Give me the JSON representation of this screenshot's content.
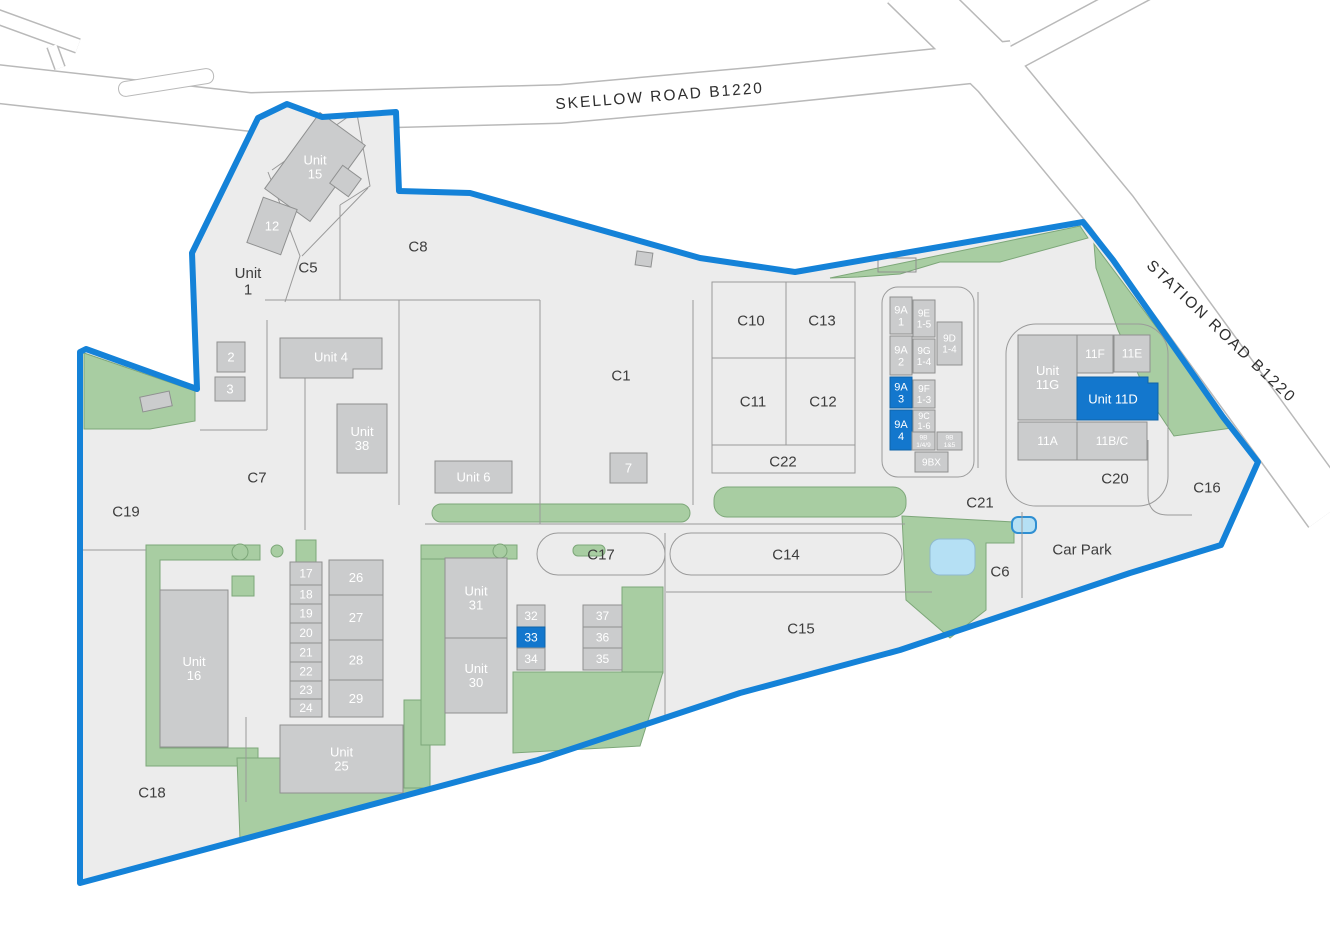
{
  "roads": {
    "skellow_label": "SKELLOW ROAD   B1220",
    "station_label": "STATION ROAD   B1220"
  },
  "colors": {
    "boundary": "#1482d8",
    "highlight": "#1377cd",
    "highlight_stroke": "#0f63a8",
    "building_fill": "#cbcccd",
    "building_stroke": "#8f9090",
    "parcel_fill": "#ececec",
    "line": "#9a9a9a",
    "green": "#a8cda2",
    "green_stroke": "#7da779",
    "pond": "#b5e0f4",
    "pond_stroke": "#8fb9cf",
    "small_pond_stroke": "#2f8fd2",
    "road_stroke": "#b9b9b9",
    "label": "#3d3d3d",
    "building_label": "#ffffff"
  },
  "parcels": [
    {
      "id": "unit-1",
      "lines": [
        "Unit",
        "1"
      ],
      "x": 248,
      "y": 281
    },
    {
      "id": "c5",
      "lines": [
        "C5"
      ],
      "x": 308,
      "y": 267
    },
    {
      "id": "c8",
      "lines": [
        "C8"
      ],
      "x": 418,
      "y": 246
    },
    {
      "id": "c7",
      "lines": [
        "C7"
      ],
      "x": 257,
      "y": 477
    },
    {
      "id": "c1",
      "lines": [
        "C1"
      ],
      "x": 621,
      "y": 375
    },
    {
      "id": "c10",
      "lines": [
        "C10"
      ],
      "x": 751,
      "y": 320
    },
    {
      "id": "c13",
      "lines": [
        "C13"
      ],
      "x": 822,
      "y": 320
    },
    {
      "id": "c11",
      "lines": [
        "C11"
      ],
      "x": 753,
      "y": 401
    },
    {
      "id": "c12",
      "lines": [
        "C12"
      ],
      "x": 823,
      "y": 401
    },
    {
      "id": "c22",
      "lines": [
        "C22"
      ],
      "x": 783,
      "y": 461
    },
    {
      "id": "c19",
      "lines": [
        "C19"
      ],
      "x": 126,
      "y": 511
    },
    {
      "id": "c18",
      "lines": [
        "C18"
      ],
      "x": 152,
      "y": 792
    },
    {
      "id": "c17",
      "lines": [
        "C17"
      ],
      "x": 601,
      "y": 554
    },
    {
      "id": "c14",
      "lines": [
        "C14"
      ],
      "x": 786,
      "y": 554
    },
    {
      "id": "c15",
      "lines": [
        "C15"
      ],
      "x": 801,
      "y": 628
    },
    {
      "id": "c21",
      "lines": [
        "C21"
      ],
      "x": 980,
      "y": 502
    },
    {
      "id": "c6",
      "lines": [
        "C6"
      ],
      "x": 1000,
      "y": 571
    },
    {
      "id": "car-park",
      "lines": [
        "Car Park"
      ],
      "x": 1082,
      "y": 549
    },
    {
      "id": "c20",
      "lines": [
        "C20"
      ],
      "x": 1115,
      "y": 478
    },
    {
      "id": "c16",
      "lines": [
        "C16"
      ],
      "x": 1207,
      "y": 487
    }
  ],
  "buildings": [
    {
      "id": "unit-15",
      "lines": [
        "Unit",
        "15"
      ],
      "x": 287,
      "y": 120,
      "w": 56,
      "h": 94,
      "rot": 36,
      "fs": 13
    },
    {
      "id": "unit-15-annex",
      "lines": [],
      "x": 334,
      "y": 170,
      "w": 23,
      "h": 22,
      "rot": 36
    },
    {
      "id": "unit-12",
      "lines": [
        "12"
      ],
      "x": 254,
      "y": 202,
      "w": 36,
      "h": 48,
      "rot": 20,
      "fs": 13
    },
    {
      "id": "unit-2",
      "lines": [
        "2"
      ],
      "x": 217,
      "y": 342,
      "w": 28,
      "h": 30,
      "fs": 13
    },
    {
      "id": "unit-3",
      "lines": [
        "3"
      ],
      "x": 215,
      "y": 377,
      "w": 30,
      "h": 24,
      "fs": 13
    },
    {
      "id": "unit-4",
      "lines": [
        "Unit 4"
      ],
      "pts": "280,338 382,338 382,369 353,369 353,378 280,378",
      "lx": 331,
      "ly": 357,
      "fs": 13
    },
    {
      "id": "unit-38",
      "lines": [
        "Unit",
        "38"
      ],
      "x": 337,
      "y": 404,
      "w": 50,
      "h": 69,
      "fs": 13
    },
    {
      "id": "unit-6",
      "lines": [
        "Unit 6"
      ],
      "x": 435,
      "y": 461,
      "w": 77,
      "h": 32,
      "fs": 13
    },
    {
      "id": "unit-7",
      "lines": [
        "7"
      ],
      "x": 610,
      "y": 453,
      "w": 37,
      "h": 30,
      "fs": 13
    },
    {
      "id": "kiosk-c1",
      "lines": [],
      "x": 636,
      "y": 252,
      "w": 16,
      "h": 14,
      "rot": 8
    },
    {
      "id": "kiosk-west",
      "lines": [],
      "x": 141,
      "y": 394,
      "w": 30,
      "h": 15,
      "rot": -12
    },
    {
      "id": "unit-9a1",
      "lines": [
        "9A",
        "1"
      ],
      "x": 890,
      "y": 297,
      "w": 22,
      "h": 37,
      "fs": 11
    },
    {
      "id": "unit-9e",
      "lines": [
        "9E",
        "1-5"
      ],
      "x": 913,
      "y": 300,
      "w": 22,
      "h": 37,
      "fs": 10
    },
    {
      "id": "unit-9a2",
      "lines": [
        "9A",
        "2"
      ],
      "x": 890,
      "y": 336,
      "w": 22,
      "h": 39,
      "fs": 11
    },
    {
      "id": "unit-9g",
      "lines": [
        "9G",
        "1-4"
      ],
      "x": 913,
      "y": 339,
      "w": 22,
      "h": 34,
      "fs": 10
    },
    {
      "id": "unit-9d",
      "lines": [
        "9D",
        "1-4"
      ],
      "x": 937,
      "y": 322,
      "w": 25,
      "h": 43,
      "fs": 10
    },
    {
      "id": "unit-9a3",
      "lines": [
        "9A",
        "3"
      ],
      "x": 890,
      "y": 377,
      "w": 22,
      "h": 31,
      "hl": true,
      "fs": 11
    },
    {
      "id": "unit-9f",
      "lines": [
        "9F",
        "1-3"
      ],
      "x": 913,
      "y": 380,
      "w": 22,
      "h": 28,
      "fs": 10
    },
    {
      "id": "unit-9a4",
      "lines": [
        "9A",
        "4"
      ],
      "x": 890,
      "y": 410,
      "w": 22,
      "h": 40,
      "hl": true,
      "fs": 11
    },
    {
      "id": "unit-9c",
      "lines": [
        "9C",
        "1-6"
      ],
      "x": 913,
      "y": 410,
      "w": 22,
      "h": 22,
      "fs": 9
    },
    {
      "id": "unit-9b-149",
      "lines": [
        "9B",
        "1/4/9"
      ],
      "x": 912,
      "y": 432,
      "w": 23,
      "h": 18,
      "fs": 6.5
    },
    {
      "id": "unit-9b-15",
      "lines": [
        "9B",
        "1&5"
      ],
      "x": 937,
      "y": 432,
      "w": 25,
      "h": 18,
      "fs": 6.5
    },
    {
      "id": "unit-9bx",
      "lines": [
        "9BX"
      ],
      "x": 915,
      "y": 452,
      "w": 33,
      "h": 20,
      "fs": 10
    },
    {
      "id": "unit-11g",
      "lines": [
        "Unit",
        "11G"
      ],
      "x": 1018,
      "y": 335,
      "w": 59,
      "h": 85,
      "fs": 13
    },
    {
      "id": "unit-11f",
      "lines": [
        "11F"
      ],
      "x": 1077,
      "y": 335,
      "w": 36,
      "h": 38,
      "fs": 12
    },
    {
      "id": "unit-11e",
      "lines": [
        "11E"
      ],
      "x": 1114,
      "y": 335,
      "w": 36,
      "h": 37,
      "fs": 12
    },
    {
      "id": "unit-11d",
      "lines": [
        "Unit 11D"
      ],
      "pts": "1077,377 1148,377 1148,383 1158,383 1158,420 1077,420",
      "lx": 1113,
      "ly": 399,
      "hl": true,
      "fs": 13
    },
    {
      "id": "unit-11a",
      "lines": [
        "11A"
      ],
      "x": 1018,
      "y": 422,
      "w": 59,
      "h": 38,
      "fs": 12
    },
    {
      "id": "unit-11bc",
      "lines": [
        "11B/C"
      ],
      "x": 1077,
      "y": 422,
      "w": 70,
      "h": 38,
      "fs": 12
    },
    {
      "id": "unit-16",
      "lines": [
        "Unit",
        "16"
      ],
      "x": 160,
      "y": 590,
      "w": 68,
      "h": 157,
      "fs": 13
    },
    {
      "id": "unit-17",
      "lines": [
        "17"
      ],
      "x": 290,
      "y": 562,
      "w": 32,
      "h": 23,
      "fs": 12
    },
    {
      "id": "unit-18",
      "lines": [
        "18"
      ],
      "x": 290,
      "y": 585,
      "w": 32,
      "h": 19,
      "fs": 12
    },
    {
      "id": "unit-19",
      "lines": [
        "19"
      ],
      "x": 290,
      "y": 604,
      "w": 32,
      "h": 19,
      "fs": 12
    },
    {
      "id": "unit-20",
      "lines": [
        "20"
      ],
      "x": 290,
      "y": 623,
      "w": 32,
      "h": 20,
      "fs": 12
    },
    {
      "id": "unit-21",
      "lines": [
        "21"
      ],
      "x": 290,
      "y": 643,
      "w": 32,
      "h": 19,
      "fs": 12
    },
    {
      "id": "unit-22",
      "lines": [
        "22"
      ],
      "x": 290,
      "y": 662,
      "w": 32,
      "h": 19,
      "fs": 12
    },
    {
      "id": "unit-23",
      "lines": [
        "23"
      ],
      "x": 290,
      "y": 681,
      "w": 32,
      "h": 18,
      "fs": 12
    },
    {
      "id": "unit-24",
      "lines": [
        "24"
      ],
      "x": 290,
      "y": 699,
      "w": 32,
      "h": 18,
      "fs": 12
    },
    {
      "id": "unit-26",
      "lines": [
        "26"
      ],
      "x": 329,
      "y": 560,
      "w": 54,
      "h": 35,
      "fs": 13
    },
    {
      "id": "unit-27",
      "lines": [
        "27"
      ],
      "x": 329,
      "y": 595,
      "w": 54,
      "h": 45,
      "fs": 13
    },
    {
      "id": "unit-28",
      "lines": [
        "28"
      ],
      "x": 329,
      "y": 640,
      "w": 54,
      "h": 40,
      "fs": 13
    },
    {
      "id": "unit-29",
      "lines": [
        "29"
      ],
      "x": 329,
      "y": 680,
      "w": 54,
      "h": 37,
      "fs": 13
    },
    {
      "id": "unit-25",
      "lines": [
        "Unit",
        "25"
      ],
      "x": 280,
      "y": 725,
      "w": 123,
      "h": 68,
      "fs": 13
    },
    {
      "id": "unit-31",
      "lines": [
        "Unit",
        "31"
      ],
      "x": 445,
      "y": 558,
      "w": 62,
      "h": 80,
      "fs": 13
    },
    {
      "id": "unit-30",
      "lines": [
        "Unit",
        "30"
      ],
      "x": 445,
      "y": 638,
      "w": 62,
      "h": 75,
      "fs": 13
    },
    {
      "id": "unit-32",
      "lines": [
        "32"
      ],
      "x": 517,
      "y": 605,
      "w": 28,
      "h": 22,
      "fs": 12
    },
    {
      "id": "unit-33",
      "lines": [
        "33"
      ],
      "x": 517,
      "y": 627,
      "w": 28,
      "h": 21,
      "hl": true,
      "fs": 12
    },
    {
      "id": "unit-34",
      "lines": [
        "34"
      ],
      "x": 517,
      "y": 648,
      "w": 28,
      "h": 22,
      "fs": 12
    },
    {
      "id": "unit-37",
      "lines": [
        "37"
      ],
      "x": 583,
      "y": 605,
      "w": 39,
      "h": 22,
      "fs": 12
    },
    {
      "id": "unit-36",
      "lines": [
        "36"
      ],
      "x": 583,
      "y": 627,
      "w": 39,
      "h": 21,
      "fs": 12
    },
    {
      "id": "unit-35",
      "lines": [
        "35"
      ],
      "x": 583,
      "y": 648,
      "w": 39,
      "h": 22,
      "fs": 12
    },
    {
      "id": "footprint-ne",
      "lines": [],
      "x": 878,
      "y": 258,
      "w": 38,
      "h": 14,
      "outline": true
    }
  ]
}
